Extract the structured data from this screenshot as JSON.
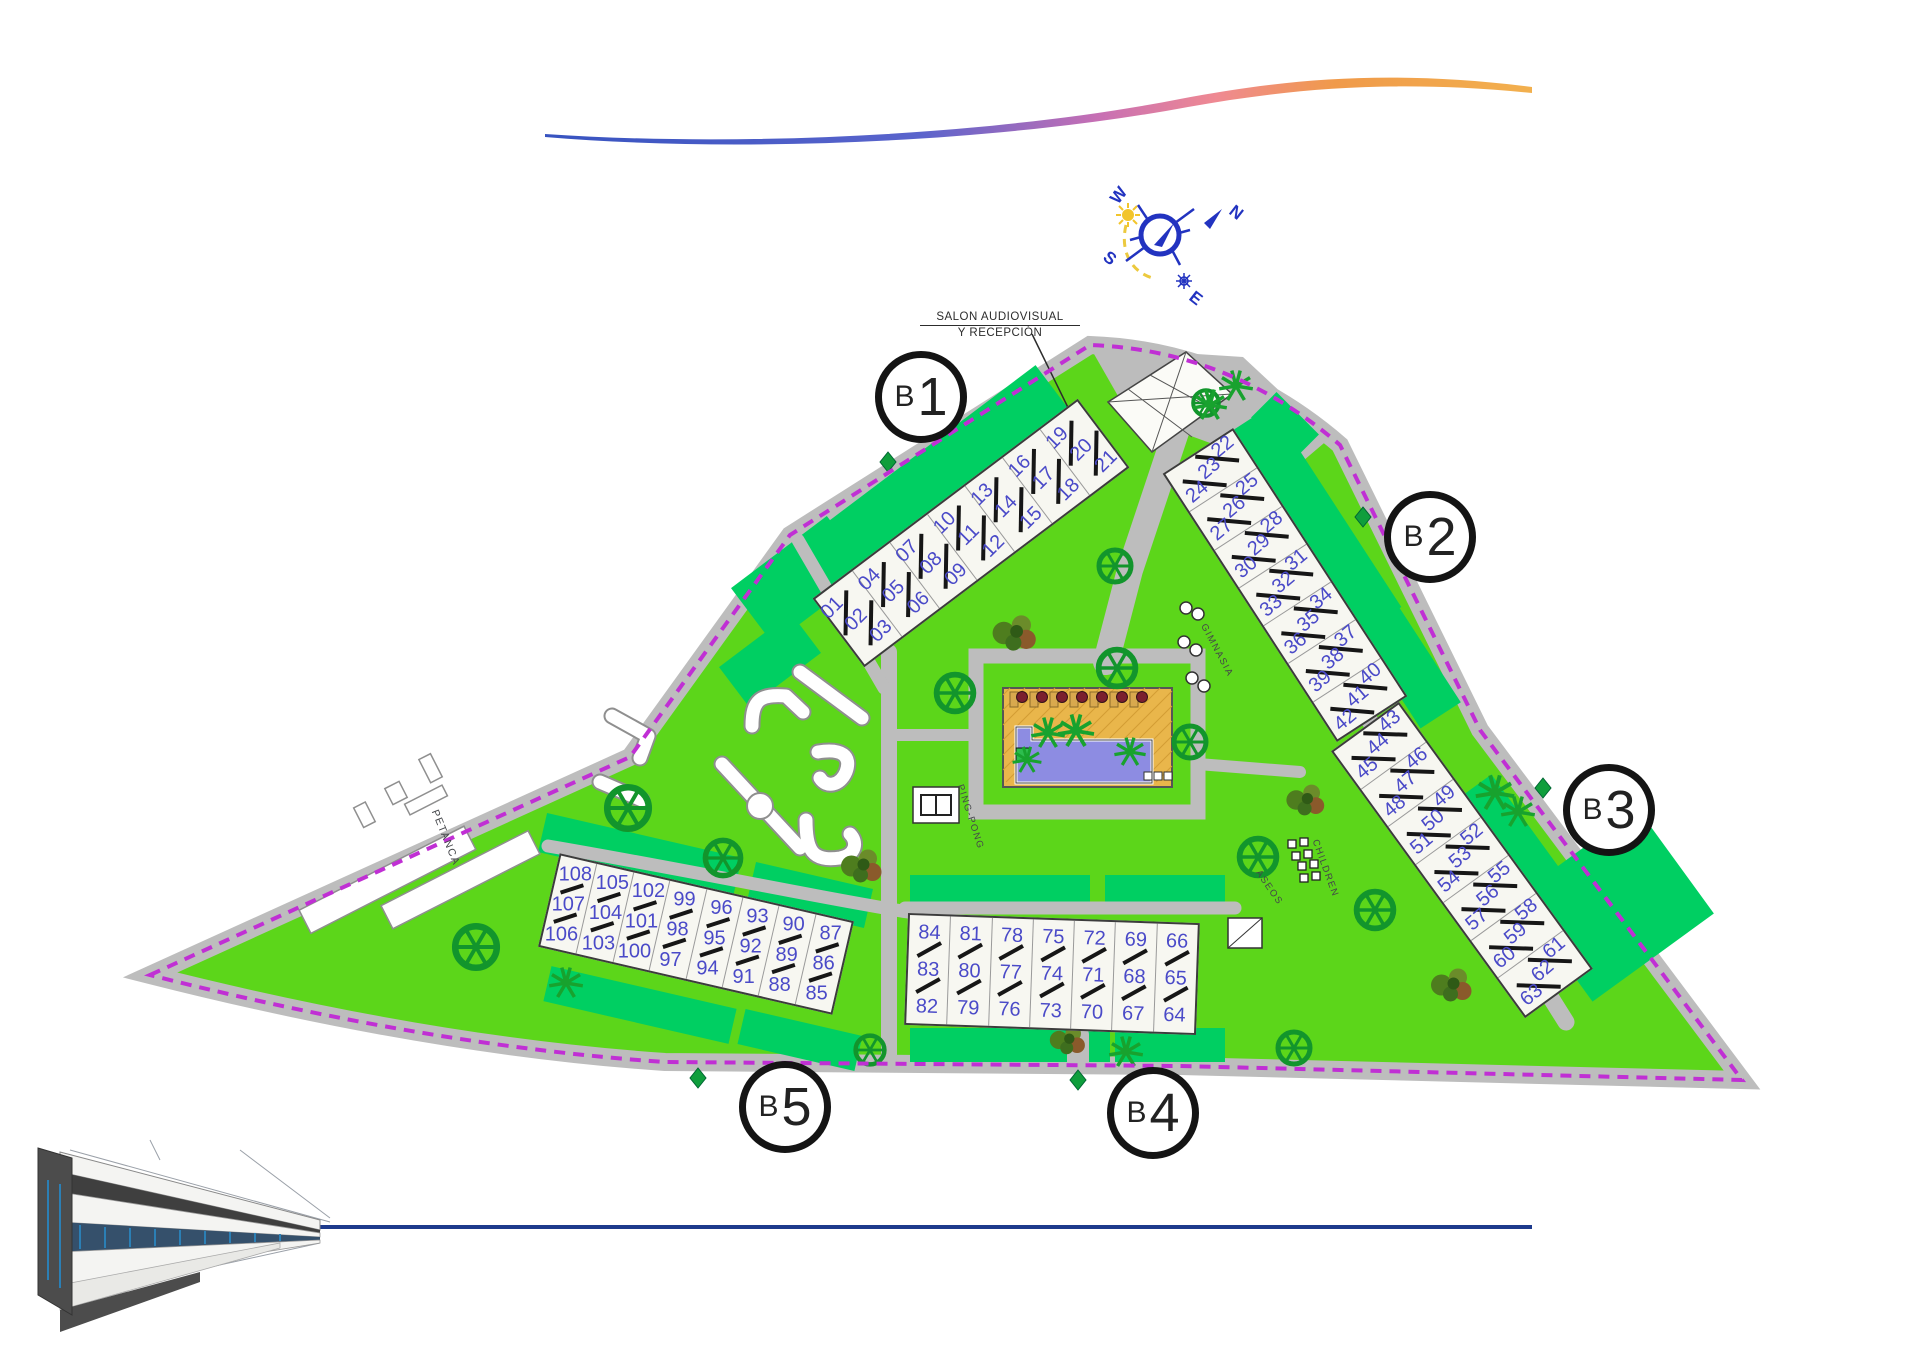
{
  "title": "Residential masterplan with unit blocks B1-B5",
  "colors": {
    "lawn": "#5cd61a",
    "garden_patch": "#00cf62",
    "road": "#bdbdbd",
    "boundary": "#c02fd4",
    "building_fill": "#f7f7f1",
    "unit_number": "#4a4ac8",
    "pool_deck": "#e9b64b",
    "pool_water": "#8d8ce2",
    "tree": "#12952c",
    "compass_blue": "#2233c0",
    "sun_yellow": "#f2c52c",
    "swoosh_blue": "#3753c0",
    "swoosh_pink": "#ef6aa0",
    "swoosh_orange": "#f2a93c",
    "footer_line": "#1d3a8c"
  },
  "compass": {
    "north": "N",
    "south": "S",
    "east": "E",
    "west": "W"
  },
  "labels": {
    "reception_line1": "SALON AUDIOVISUAL",
    "reception_line2": "Y RECEPCIÓN",
    "petanca": "PETANCA",
    "ping_pong": "PING-PONG",
    "gimnasia": "GIMNASIA",
    "children": "CHILDREN",
    "aseos": "ASEOS"
  },
  "blocks": [
    {
      "id": "b1",
      "prefix": "B",
      "number": "1",
      "circle": {
        "x": 921,
        "y": 397
      },
      "bar": {
        "cx": 971,
        "cy": 533,
        "w": 332,
        "h": 86,
        "rot": -37,
        "textRot": -8,
        "mode": "diag"
      },
      "groups": [
        [
          "01",
          "02",
          "03"
        ],
        [
          "04",
          "05",
          "06"
        ],
        [
          "07",
          "08",
          "09"
        ],
        [
          "10",
          "11",
          "12"
        ],
        [
          "13",
          "14",
          "15"
        ],
        [
          "16",
          "17",
          "18"
        ],
        [
          "19",
          "20",
          "21"
        ]
      ]
    },
    {
      "id": "b2",
      "prefix": "B",
      "number": "2",
      "circle": {
        "x": 1430,
        "y": 537
      },
      "bar": {
        "cx": 1285,
        "cy": 585,
        "w": 320,
        "h": 84,
        "rot": 57,
        "textRot": -97,
        "mode": "diag"
      },
      "groups": [
        [
          "22",
          "23",
          "24"
        ],
        [
          "25",
          "26",
          "27"
        ],
        [
          "28",
          "29",
          "30"
        ],
        [
          "31",
          "32",
          "33"
        ],
        [
          "34",
          "35",
          "36"
        ],
        [
          "37",
          "38",
          "39"
        ],
        [
          "40",
          "41",
          "42"
        ]
      ]
    },
    {
      "id": "b3",
      "prefix": "B",
      "number": "3",
      "circle": {
        "x": 1609,
        "y": 810
      },
      "bar": {
        "cx": 1462,
        "cy": 860,
        "w": 330,
        "h": 84,
        "rot": 54,
        "textRot": -94,
        "mode": "diag"
      },
      "groups": [
        [
          "43",
          "44",
          "45"
        ],
        [
          "46",
          "47",
          "48"
        ],
        [
          "49",
          "50",
          "51"
        ],
        [
          "52",
          "53",
          "54"
        ],
        [
          "55",
          "56",
          "57"
        ],
        [
          "58",
          "59",
          "60"
        ],
        [
          "61",
          "62",
          "63"
        ]
      ]
    },
    {
      "id": "b4",
      "prefix": "B",
      "number": "4",
      "circle": {
        "x": 1153,
        "y": 1113
      },
      "bar": {
        "cx": 1052,
        "cy": 974,
        "w": 292,
        "h": 112,
        "rot": 2,
        "textRot": 0,
        "mode": "stacked"
      },
      "groups": [
        [
          "84",
          "83",
          "82"
        ],
        [
          "81",
          "80",
          "79"
        ],
        [
          "78",
          "77",
          "76"
        ],
        [
          "75",
          "74",
          "73"
        ],
        [
          "72",
          "71",
          "70"
        ],
        [
          "69",
          "68",
          "67"
        ],
        [
          "66",
          "65",
          "64"
        ]
      ]
    },
    {
      "id": "b5",
      "prefix": "B",
      "number": "5",
      "circle": {
        "x": 785,
        "y": 1107
      },
      "bar": {
        "cx": 696,
        "cy": 934,
        "w": 302,
        "h": 96,
        "rot": 13,
        "textRot": -13,
        "mode": "stacked"
      },
      "groups": [
        [
          "108",
          "107",
          "106"
        ],
        [
          "105",
          "104",
          "103"
        ],
        [
          "102",
          "101",
          "100"
        ],
        [
          "99",
          "98",
          "97"
        ],
        [
          "96",
          "95",
          "94"
        ],
        [
          "93",
          "92",
          "91"
        ],
        [
          "90",
          "89",
          "88"
        ],
        [
          "87",
          "86",
          "85"
        ]
      ]
    }
  ]
}
